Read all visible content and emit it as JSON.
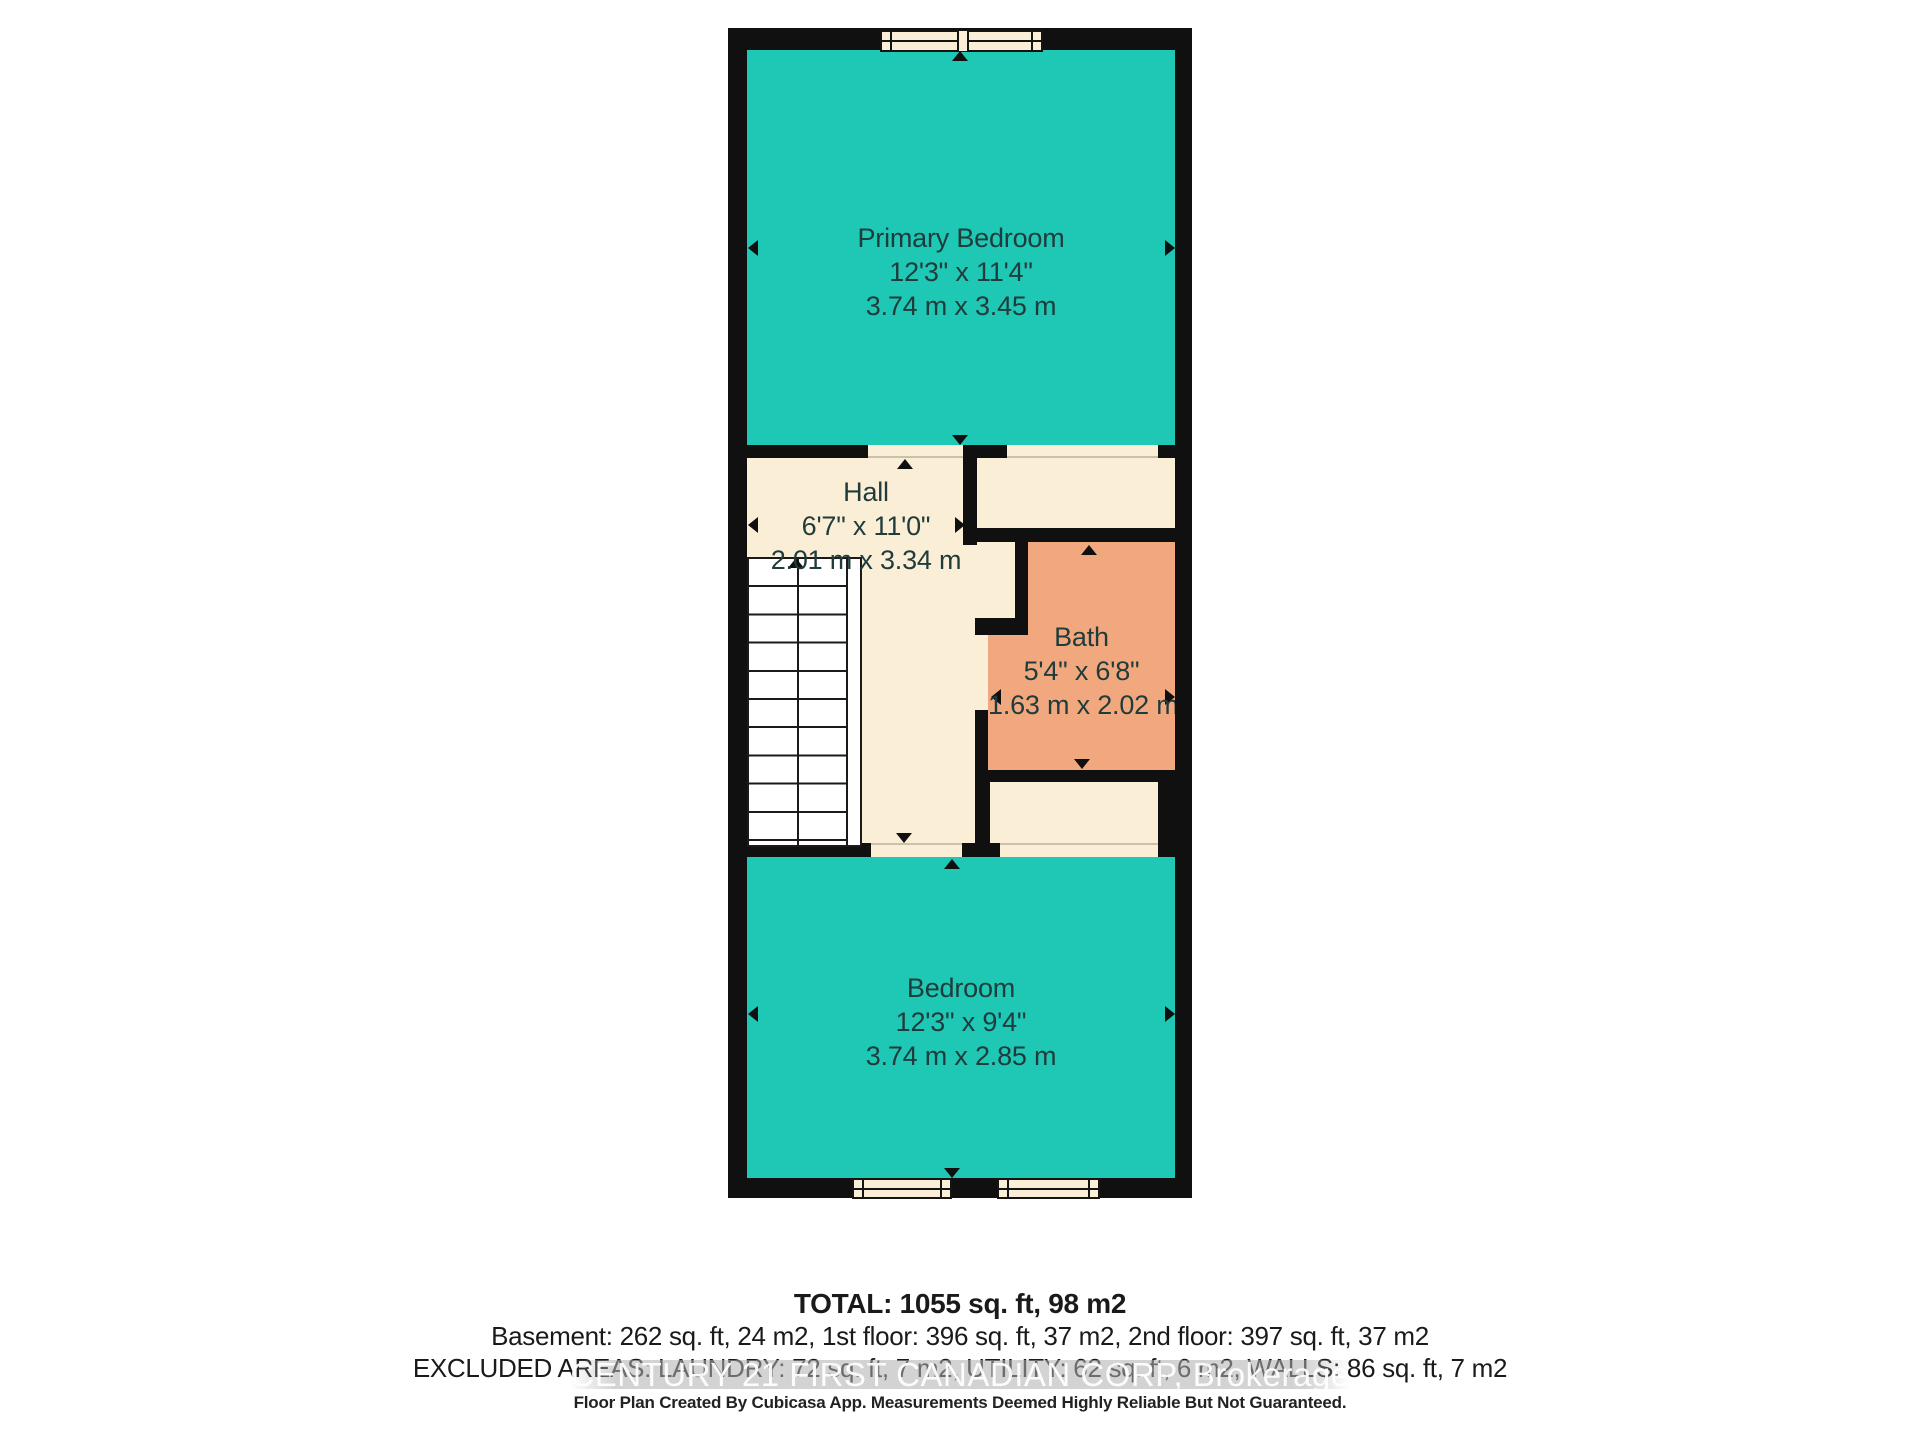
{
  "colors": {
    "room_teal": "#1fc7b5",
    "room_cream": "#faefd6",
    "room_salmon": "#f2a87e",
    "wall_black": "#101010",
    "label_text": "#1f3b3b"
  },
  "floor_plan": {
    "rooms": [
      {
        "id": "primary-bedroom",
        "name": "Primary Bedroom",
        "dim_imperial": "12'3\" x 11'4\"",
        "dim_metric": "3.74 m x 3.45 m"
      },
      {
        "id": "hall",
        "name": "Hall",
        "dim_imperial": "6'7\" x 11'0\"",
        "dim_metric": "2.01 m x 3.34 m"
      },
      {
        "id": "bath",
        "name": "Bath",
        "dim_imperial": "5'4\" x 6'8\"",
        "dim_metric": "1.63 m x 2.02 m"
      },
      {
        "id": "bedroom",
        "name": "Bedroom",
        "dim_imperial": "12'3\" x 9'4\"",
        "dim_metric": "3.74 m x 2.85 m"
      }
    ]
  },
  "footer": {
    "total": "TOTAL: 1055 sq. ft, 98 m2",
    "floors": "Basement: 262 sq. ft, 24 m2, 1st floor: 396 sq. ft, 37 m2, 2nd floor: 397 sq. ft, 37 m2",
    "excluded": "EXCLUDED AREAS: LAUNDRY: 72 sq. ft, 7 m2, UTILITY: 62 sq. ft, 6 m2, WALLS: 86 sq. ft, 7 m2",
    "watermark": "CENTURY 21 FIRST CANADIAN CORP, Brokerage",
    "disclaimer": "Floor Plan Created By Cubicasa App. Measurements Deemed Highly Reliable But Not Guaranteed."
  }
}
